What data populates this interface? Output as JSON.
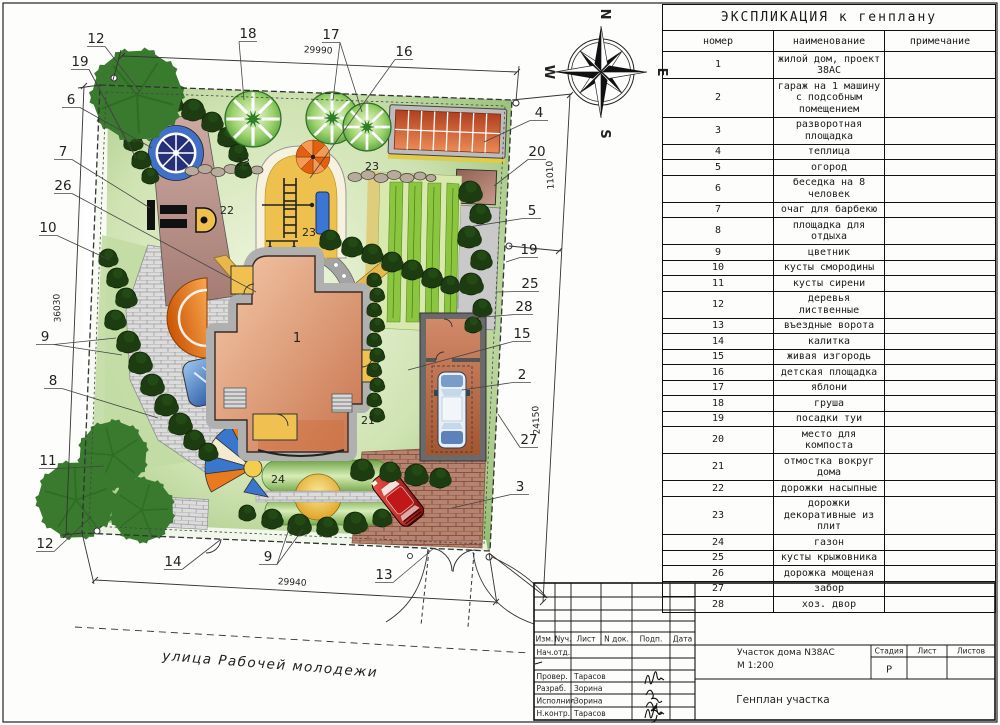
{
  "explication": {
    "title": "ЭКСПЛИКАЦИЯ к генплану",
    "columns": [
      "номер",
      "наименование",
      "примечание"
    ],
    "rows": [
      [
        "1",
        "жилой дом, проект 38АС"
      ],
      [
        "2",
        "гараж на 1 машину с подсобным помещением"
      ],
      [
        "3",
        "разворотная площадка"
      ],
      [
        "4",
        "теплица"
      ],
      [
        "5",
        "огород"
      ],
      [
        "6",
        "беседка на 8 человек"
      ],
      [
        "7",
        "очаг для барбекю"
      ],
      [
        "8",
        "площадка для отдыха"
      ],
      [
        "9",
        "цветник"
      ],
      [
        "10",
        "кусты смородины"
      ],
      [
        "11",
        "кусты сирени"
      ],
      [
        "12",
        "деревья лиственные"
      ],
      [
        "13",
        "въездные ворота"
      ],
      [
        "14",
        "калитка"
      ],
      [
        "15",
        "живая изгородь"
      ],
      [
        "16",
        "детская площадка"
      ],
      [
        "17",
        "яблони"
      ],
      [
        "18",
        "груша"
      ],
      [
        "19",
        "посадки туи"
      ],
      [
        "20",
        "место для компоста"
      ],
      [
        "21",
        "отмостка вокруг дома"
      ],
      [
        "22",
        "дорожки насыпные"
      ],
      [
        "23",
        "дорожки декоративные из плит"
      ],
      [
        "24",
        "газон"
      ],
      [
        "25",
        "кусты крыжовника"
      ],
      [
        "26",
        "дорожка мощеная"
      ],
      [
        "27",
        "забор"
      ],
      [
        "28",
        "хоз. двор"
      ]
    ]
  },
  "stamp": {
    "header_cols": [
      "Изм.",
      "Nуч.",
      "Лист",
      "N док.",
      "Подп.",
      "Дата"
    ],
    "rows": [
      {
        "role": "Нач.отд.",
        "name": ""
      },
      {
        "role": "Провер.",
        "name": "Тарасов"
      },
      {
        "role": "Разраб.",
        "name": "Зорина"
      },
      {
        "role": "Исполнил",
        "name": "Зорина"
      },
      {
        "role": "Н.контр.",
        "name": "Тарасов"
      }
    ],
    "project": "Участок дома N38АС",
    "scale": "М 1:200",
    "doc_title": "Генплан участка",
    "stage_label": "Стадия",
    "sheet_label": "Лист",
    "sheets_label": "Листов",
    "stage_value": "Р"
  },
  "plan": {
    "street": "улица Рабочей молодежи",
    "dims": {
      "top": "29990",
      "left": "36030",
      "right_upper": "11010",
      "right_lower": "24150",
      "bottom": "29940"
    },
    "compass": {
      "n": "N",
      "e": "E",
      "s": "S",
      "w": "W"
    },
    "house_number": "1",
    "callouts": [
      {
        "n": "12",
        "x": 96,
        "y": 43,
        "t": [
          [
            140,
            92
          ]
        ]
      },
      {
        "n": "19",
        "x": 80,
        "y": 66,
        "t": [
          [
            126,
            140
          ],
          [
            136,
            158
          ]
        ]
      },
      {
        "n": "6",
        "x": 71,
        "y": 104,
        "t": [
          [
            152,
            148
          ]
        ]
      },
      {
        "n": "7",
        "x": 63,
        "y": 156,
        "t": [
          [
            150,
            208
          ]
        ]
      },
      {
        "n": "26",
        "x": 63,
        "y": 190,
        "t": [
          [
            256,
            292
          ]
        ]
      },
      {
        "n": "10",
        "x": 48,
        "y": 232,
        "t": [
          [
            110,
            260
          ]
        ]
      },
      {
        "n": "9",
        "x": 45,
        "y": 341,
        "t": [
          [
            116,
            338
          ],
          [
            122,
            355
          ]
        ]
      },
      {
        "n": "8",
        "x": 53,
        "y": 385,
        "t": [
          [
            158,
            418
          ]
        ]
      },
      {
        "n": "11",
        "x": 48,
        "y": 465,
        "t": [
          [
            104,
            466
          ]
        ]
      },
      {
        "n": "12",
        "x": 45,
        "y": 548,
        "t": [
          [
            92,
            516
          ]
        ]
      },
      {
        "n": "18",
        "x": 248,
        "y": 38,
        "t": [
          [
            244,
            100
          ]
        ]
      },
      {
        "n": "17",
        "x": 331,
        "y": 39,
        "t": [
          [
            333,
            100
          ],
          [
            362,
            112
          ]
        ]
      },
      {
        "n": "16",
        "x": 404,
        "y": 56,
        "t": [
          [
            310,
            178
          ]
        ]
      },
      {
        "n": "4",
        "x": 539,
        "y": 117,
        "t": [
          [
            484,
            142
          ]
        ]
      },
      {
        "n": "20",
        "x": 537,
        "y": 156,
        "t": [
          [
            494,
            186
          ]
        ]
      },
      {
        "n": "5",
        "x": 532,
        "y": 215,
        "t": [
          [
            462,
            228
          ]
        ]
      },
      {
        "n": "19",
        "x": 529,
        "y": 254,
        "t": [
          [
            506,
            262
          ]
        ]
      },
      {
        "n": "25",
        "x": 530,
        "y": 288,
        "t": [
          [
            496,
            292
          ]
        ]
      },
      {
        "n": "28",
        "x": 524,
        "y": 311,
        "t": [
          [
            470,
            318
          ]
        ]
      },
      {
        "n": "15",
        "x": 522,
        "y": 338,
        "t": [
          [
            408,
            370
          ]
        ]
      },
      {
        "n": "2",
        "x": 522,
        "y": 379,
        "t": [
          [
            462,
            390
          ]
        ]
      },
      {
        "n": "27",
        "x": 529,
        "y": 444,
        "t": [
          [
            498,
            414
          ]
        ]
      },
      {
        "n": "3",
        "x": 520,
        "y": 491,
        "t": [
          [
            452,
            508
          ]
        ]
      },
      {
        "n": "14",
        "x": 173,
        "y": 566,
        "t": [
          [
            220,
            540
          ]
        ]
      },
      {
        "n": "9",
        "x": 268,
        "y": 561,
        "t": [
          [
            290,
            526
          ],
          [
            303,
            529
          ]
        ]
      },
      {
        "n": "13",
        "x": 384,
        "y": 579,
        "t": [
          [
            434,
            548
          ]
        ]
      },
      {
        "n": "1",
        "x": 297,
        "y": 342,
        "t": [],
        "s": 13
      },
      {
        "n": "21",
        "x": 368,
        "y": 424,
        "t": [],
        "s": 11
      },
      {
        "n": "22",
        "x": 227,
        "y": 214,
        "t": [],
        "s": 11
      },
      {
        "n": "23",
        "x": 243,
        "y": 166,
        "t": [],
        "s": 11
      },
      {
        "n": "23",
        "x": 372,
        "y": 170,
        "t": [],
        "s": 11
      },
      {
        "n": "23",
        "x": 309,
        "y": 236,
        "t": [],
        "s": 11
      },
      {
        "n": "24",
        "x": 278,
        "y": 483,
        "t": [],
        "s": 11
      }
    ]
  }
}
